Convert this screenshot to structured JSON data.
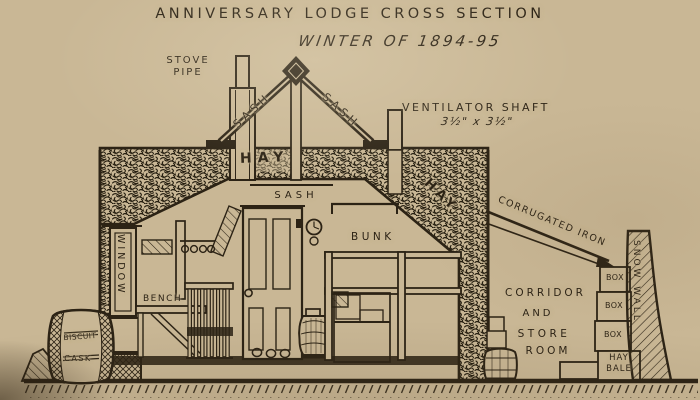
{
  "title": {
    "line1": "ANNIVERSARY LODGE CROSS SECTION",
    "line2": "WINTER OF 1894-95"
  },
  "roof": {
    "stove_pipe": [
      "STOVE",
      "PIPE"
    ],
    "sash_left": "SASH",
    "sash_right": "SASH",
    "hay_top": "HAY",
    "hay_slope": "HAY",
    "ventilator": {
      "name": "VENTILATOR SHAFT",
      "size": "3½\" x 3½\""
    }
  },
  "interior": {
    "sash_ceiling": "SASH",
    "window_vertical": "WINDOW",
    "bench": "BENCH",
    "bunk": "BUNK"
  },
  "corridor": {
    "roof_label": "CORRUGATED IRON",
    "room_lines": [
      "CORRIDOR",
      "AND",
      "STORE",
      "ROOM"
    ],
    "boxes": [
      "BOX",
      "BOX",
      "BOX"
    ],
    "hay_bale": [
      "HAY",
      "BALE"
    ],
    "snow_wall_vertical": "SNOW WALL"
  },
  "foreground": {
    "cask": [
      "BISCUIT",
      "CASK"
    ]
  },
  "colors": {
    "paper": "#c9b795",
    "ink": "#2c2315"
  }
}
